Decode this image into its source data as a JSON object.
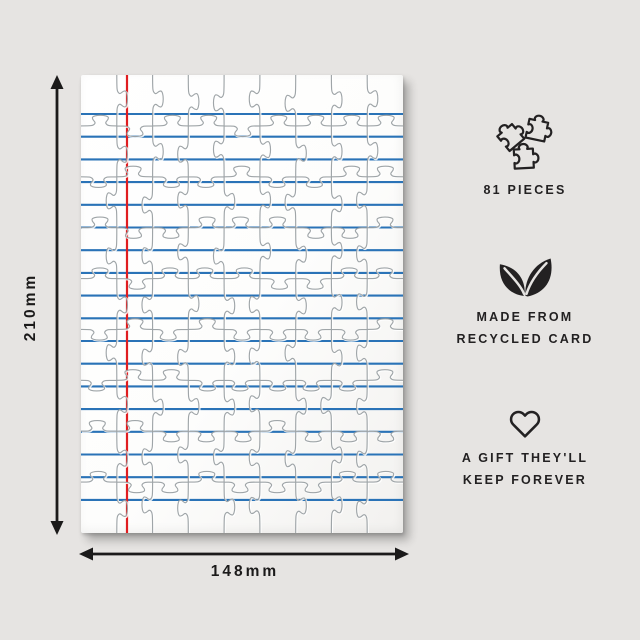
{
  "scene": {
    "background_color": "#e6e4e2",
    "text_color": "#232122"
  },
  "puzzle": {
    "pieces": 81,
    "grid_rows": 9,
    "grid_cols": 9,
    "paper_color": "#fdfdfd",
    "rule_line_color": "#1f6cb3",
    "margin_line_color": "#e01d20",
    "cut_line_color": "#9aa0a3",
    "rule_first_y": 39,
    "rule_spacing": 22.7,
    "rule_count": 18,
    "margin_line_x": 46
  },
  "dimensions": {
    "height": "210mm",
    "width": "148mm"
  },
  "features": [
    {
      "icon": "puzzle-pieces-icon",
      "lines": [
        "81 PIECES"
      ]
    },
    {
      "icon": "leaf-icon",
      "lines": [
        "MADE FROM",
        "RECYCLED CARD"
      ]
    },
    {
      "icon": "heart-icon",
      "lines": [
        "A GIFT THEY'LL",
        "KEEP FOREVER"
      ]
    }
  ]
}
